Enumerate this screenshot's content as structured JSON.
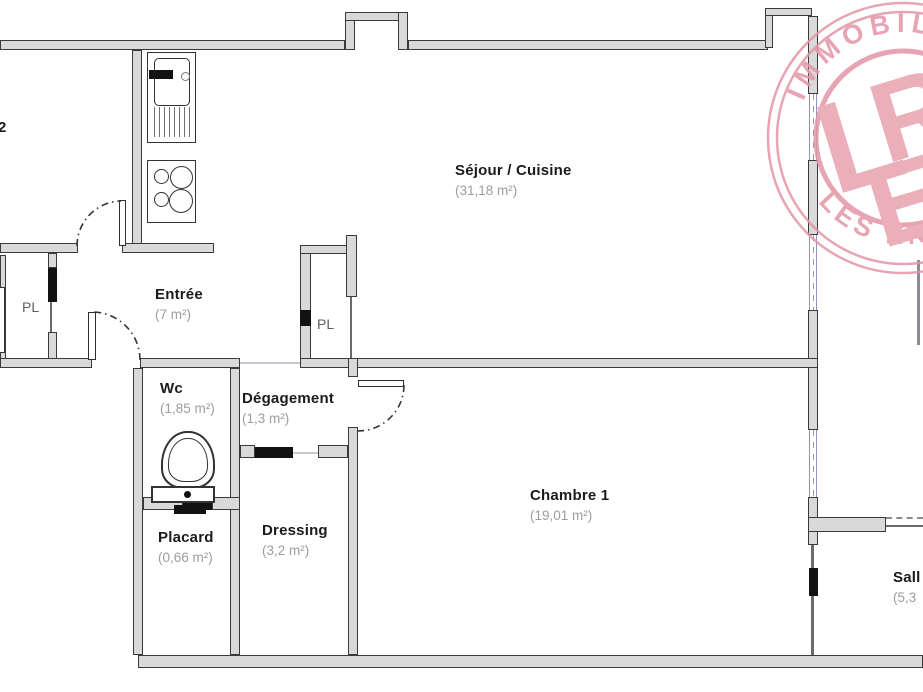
{
  "plan": {
    "title": "apartment-floor-plan",
    "rooms": {
      "sejour": {
        "name": "Séjour / Cuisine",
        "area": "(31,18 m²)"
      },
      "entree": {
        "name": "Entrée",
        "area": "(7 m²)"
      },
      "wc": {
        "name": "Wc",
        "area": "(1,85 m²)"
      },
      "degagement": {
        "name": "Dégagement",
        "area": "(1,3 m²)"
      },
      "placard": {
        "name": "Placard",
        "area": "(0,66 m²)"
      },
      "dressing": {
        "name": "Dressing",
        "area": "(3,2 m²)"
      },
      "chambre1": {
        "name": "Chambre 1",
        "area": "(19,01 m²)"
      },
      "salle_fragment": {
        "name": "Sall",
        "area": "(5,3"
      },
      "chambre2_fragment": {
        "name": "2"
      },
      "closet_left": "PL",
      "closet_center": "PL"
    },
    "fixtures": [
      "kitchen-sink",
      "stove-four-burners",
      "toilet",
      "radiator"
    ],
    "colors": {
      "wall_fill": "#d9d9d9",
      "wall_outline": "#3a3a3a",
      "window_frame": "#8e94bb",
      "room_label": "#1b1b1b",
      "area_label": "#9d9d9d",
      "watermark_pink": "#e395a6"
    }
  },
  "watermark": {
    "top_text": "IMMOBILI",
    "bottom_text": "LES ENFANTS B",
    "monogram": [
      "L",
      "R",
      "E"
    ]
  }
}
